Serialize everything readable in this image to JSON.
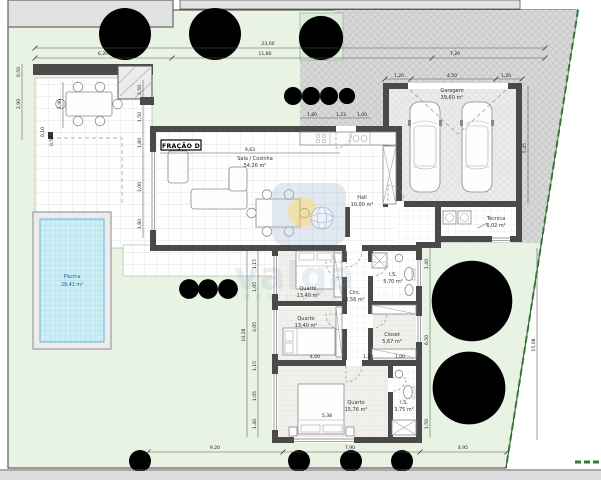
{
  "colors": {
    "lawn": "#e9f3e3",
    "paving": "#d8d8d8",
    "wall": "#4a4a4a",
    "pool_water": "#cdeef5",
    "boundary": "#2e7d32",
    "watermark": "#7d9cc9",
    "accent_gold": "#e6c14d"
  },
  "plan": {
    "fracao_label": "FRAÇÃO D",
    "rooms": {
      "sala": {
        "name": "Sala / Cozinha",
        "area": "54,26 m²"
      },
      "garagem": {
        "name": "Garagem",
        "area": "39,60 m²"
      },
      "hall": {
        "name": "Hall",
        "area": "10,00 m²"
      },
      "tecnica": {
        "name": "Técnica",
        "area": "6,02 m²"
      },
      "is1": {
        "name": "I.S.",
        "area": "5,70 m²"
      },
      "circ": {
        "name": "Circ.",
        "area": "3,56 m²"
      },
      "quarto1": {
        "name": "Quarto",
        "area": "13,40 m²"
      },
      "quarto2": {
        "name": "Quarto",
        "area": "13,40 m²"
      },
      "closet": {
        "name": "Closet",
        "area": "5,67 m²"
      },
      "quarto3": {
        "name": "Quarto",
        "area": "15,76 m²"
      },
      "is2": {
        "name": "I.S.",
        "area": "3,75 m²"
      },
      "piscina": {
        "name": "Piscina",
        "area": "28,41 m²"
      }
    },
    "dims": {
      "top_total": "23,00",
      "top_a": "6,20",
      "top_b": "11,80",
      "top_c": "7,20",
      "gar_a": "1,20",
      "gar_b": "4,50",
      "gar_c": "1,20",
      "left_a": "0,50",
      "left_b": "2,90",
      "left_c": "0,10",
      "left_d": "0,50",
      "patio_a": "2,50",
      "patio_b": "1,50",
      "patio_c": "1,80",
      "patio_d": "3,00",
      "patio_e": "1,80",
      "patio_f": "3,90",
      "sala_w": "9,63",
      "kit_a": "1,80",
      "kit_b": "1,22",
      "kit_c": "1,00",
      "right_a": "5,45",
      "right_b": "15,08",
      "wing_a": "1,15",
      "wing_b": "1,05",
      "wing_c": "3,05",
      "wing_d": "1,15",
      "wing_e": "1,05",
      "wing_f": "1,40",
      "wing_total": "10,28",
      "inner_a": "1,40",
      "inner_b": "6,50",
      "inner_c": "1,50",
      "q3_a": "4,00",
      "q3_b": "1,20",
      "q3_c": "1,00",
      "q3_w": "5,38",
      "bottom_a": "9,20",
      "bottom_b": "7,90",
      "bottom_c": "4,95"
    },
    "watermark": {
      "brand": "valga",
      "subtitle": "IMOBILIÁRIA"
    }
  }
}
